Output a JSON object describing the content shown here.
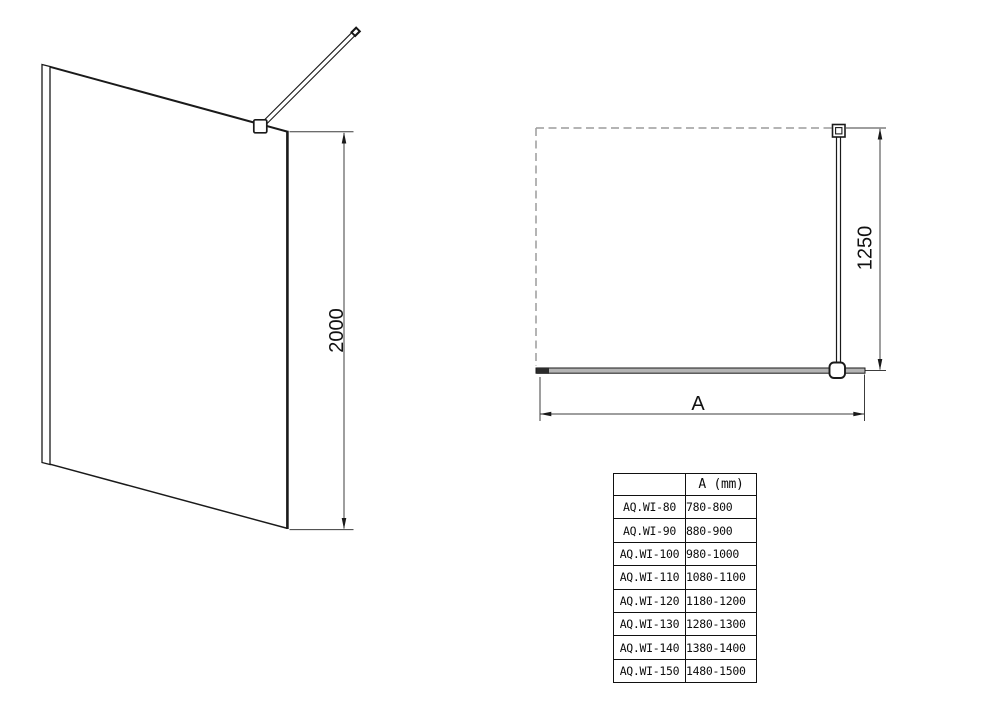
{
  "sheet": {
    "background": "#ffffff",
    "description": "walk-in shower glass panel technical drawing"
  },
  "perspective_view": {
    "height_dim": "2000"
  },
  "plan_view": {
    "depth_dim": "1250",
    "width_dim": "A"
  },
  "size_table": {
    "header": {
      "model": "",
      "dimension": "A (mm)"
    },
    "rows": [
      {
        "model": "AQ.WI-80",
        "range": "780-800"
      },
      {
        "model": "AQ.WI-90",
        "range": "880-900"
      },
      {
        "model": "AQ.WI-100",
        "range": "980-1000"
      },
      {
        "model": "AQ.WI-110",
        "range": "1080-1100"
      },
      {
        "model": "AQ.WI-120",
        "range": "1180-1200"
      },
      {
        "model": "AQ.WI-130",
        "range": "1280-1300"
      },
      {
        "model": "AQ.WI-140",
        "range": "1380-1400"
      },
      {
        "model": "AQ.WI-150",
        "range": "1480-1500"
      }
    ]
  },
  "colors": {
    "object_line": "#1a1a1a",
    "dimension_line": "#3c3c3c",
    "dashed_wall": "#9c9c9c",
    "glass_fill_plan": "#b4b4b4"
  }
}
